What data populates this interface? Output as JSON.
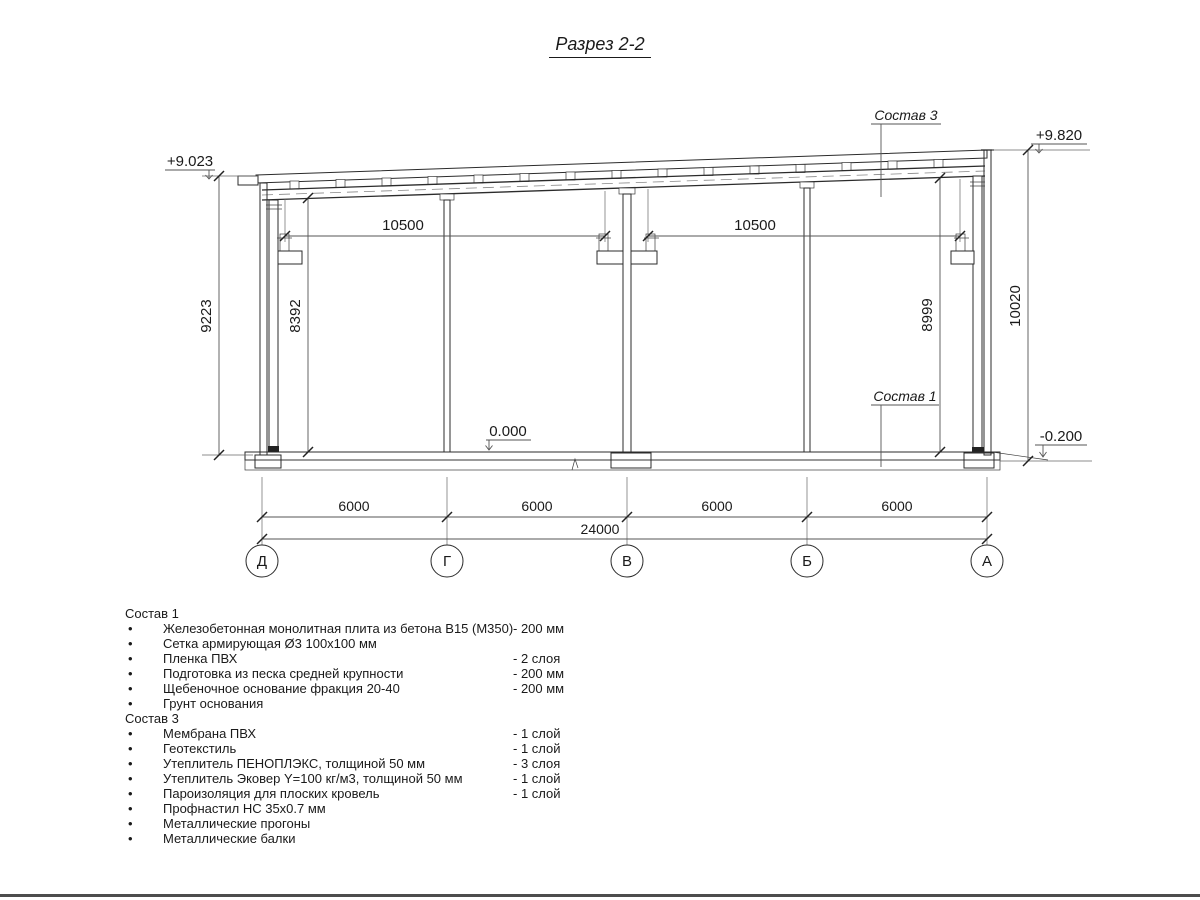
{
  "title": "Разрез 2-2",
  "colors": {
    "ink": "#1a1a1a",
    "background": "#ffffff"
  },
  "icons": {
    "bullet": "•"
  },
  "drawing": {
    "elevations": {
      "left_top": "+9.023",
      "right_top": "+9.820",
      "floor": "0.000",
      "ground": "-0.200"
    },
    "callouts": {
      "roof": "Состав 3",
      "floor": "Состав 1"
    },
    "dims": {
      "span_left": "10500",
      "span_right": "10500",
      "left_outer": "9223",
      "left_inner": "8392",
      "right_inner": "8999",
      "right_outer": "10020",
      "bays": [
        "6000",
        "6000",
        "6000",
        "6000"
      ],
      "total": "24000"
    },
    "axes": [
      "Д",
      "Г",
      "В",
      "Б",
      "А"
    ]
  },
  "comp1": {
    "header": "Состав 1",
    "items": [
      {
        "text": "Железобетонная монолитная плита из бетона В15 (М350)",
        "value": "-  200 мм"
      },
      {
        "text": "Сетка армирующая Ø3 100х100 мм",
        "value": ""
      },
      {
        "text": "Пленка ПВХ",
        "value": "-  2 слоя"
      },
      {
        "text": "Подготовка из песка средней крупности",
        "value": "- 200 мм"
      },
      {
        "text": "Щебеночное основание фракция 20-40",
        "value": "- 200 мм"
      },
      {
        "text": "Грунт основания",
        "value": ""
      }
    ]
  },
  "comp3": {
    "header": "Состав 3",
    "items": [
      {
        "text": "Мембрана ПВХ",
        "value": "- 1 слой"
      },
      {
        "text": "Геотекстиль",
        "value": "- 1 слой"
      },
      {
        "text": "Утеплитель ПЕНОПЛЭКС, толщиной 50 мм",
        "value": "- 3 слоя"
      },
      {
        "text": "Утеплитель Эковер Y=100 кг/м3, толщиной 50 мм",
        "value": "- 1 слой"
      },
      {
        "text": "Пароизоляция для плоских кровель",
        "value": "- 1 слой"
      },
      {
        "text": "Профнастил НС 35х0.7 мм",
        "value": ""
      },
      {
        "text": "Металлические прогоны",
        "value": ""
      },
      {
        "text": "Металлические балки",
        "value": ""
      }
    ]
  }
}
